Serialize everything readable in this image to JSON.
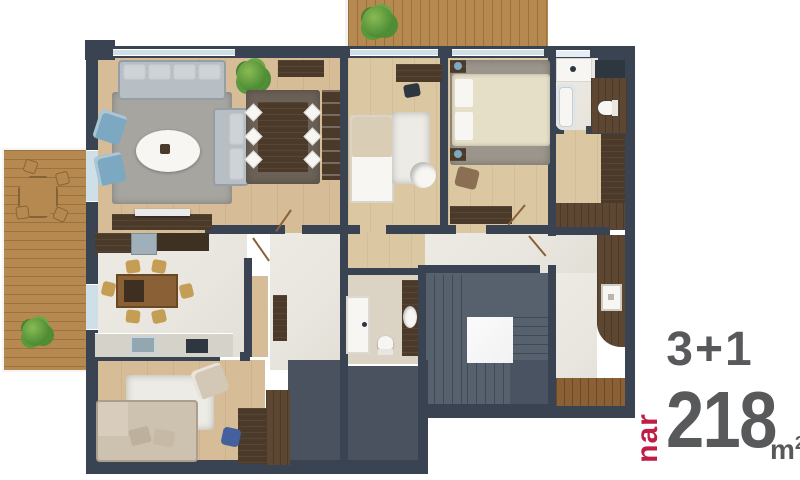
{
  "branding": {
    "room_config": "3+1",
    "brand_name": "nar",
    "area_value": "218",
    "area_unit_base": "m",
    "area_unit_exponent": "2"
  },
  "palette": {
    "wall": "#3a4351",
    "window": "#cfdfe8",
    "window_light": "#e7eef3",
    "wood_floor": "#d6bd97",
    "wood_floor2": "#dcc7a3",
    "marble": "#e9e6df",
    "beige_floor": "#dbd3c4",
    "terrace_wood": "#b5894f",
    "dark_wood": "#4b3a29",
    "dark_wood2": "#5d4732",
    "mid_wood": "#8a6136",
    "tan_chair": "#c59e55",
    "slate_floor": "#49525e",
    "stair": "#57616e",
    "stair_dark": "#4a5361",
    "landing": "#f2f2f3",
    "rug_gray": "#a7a59f",
    "rug_dark": "#6b6156",
    "rug_white": "#edebe5",
    "rug_master": "#9b958b",
    "sofa_gray": "#b7bec4",
    "sofa_cushion": "#cdd3d7",
    "sofa_beige": "#cdc1b0",
    "chair_blue": "#7da8c2",
    "desk_chair_blue": "#44609e",
    "white": "#f7f6f3",
    "plant_green": "#4e8d35",
    "appliance_gray": "#9fb0ba",
    "counter_gray": "#d5d2ca",
    "sink_blue": "#93a7b1",
    "black_fixture": "#2e3640",
    "text_gray": "#58595b",
    "brand_red": "#bf1d45"
  }
}
